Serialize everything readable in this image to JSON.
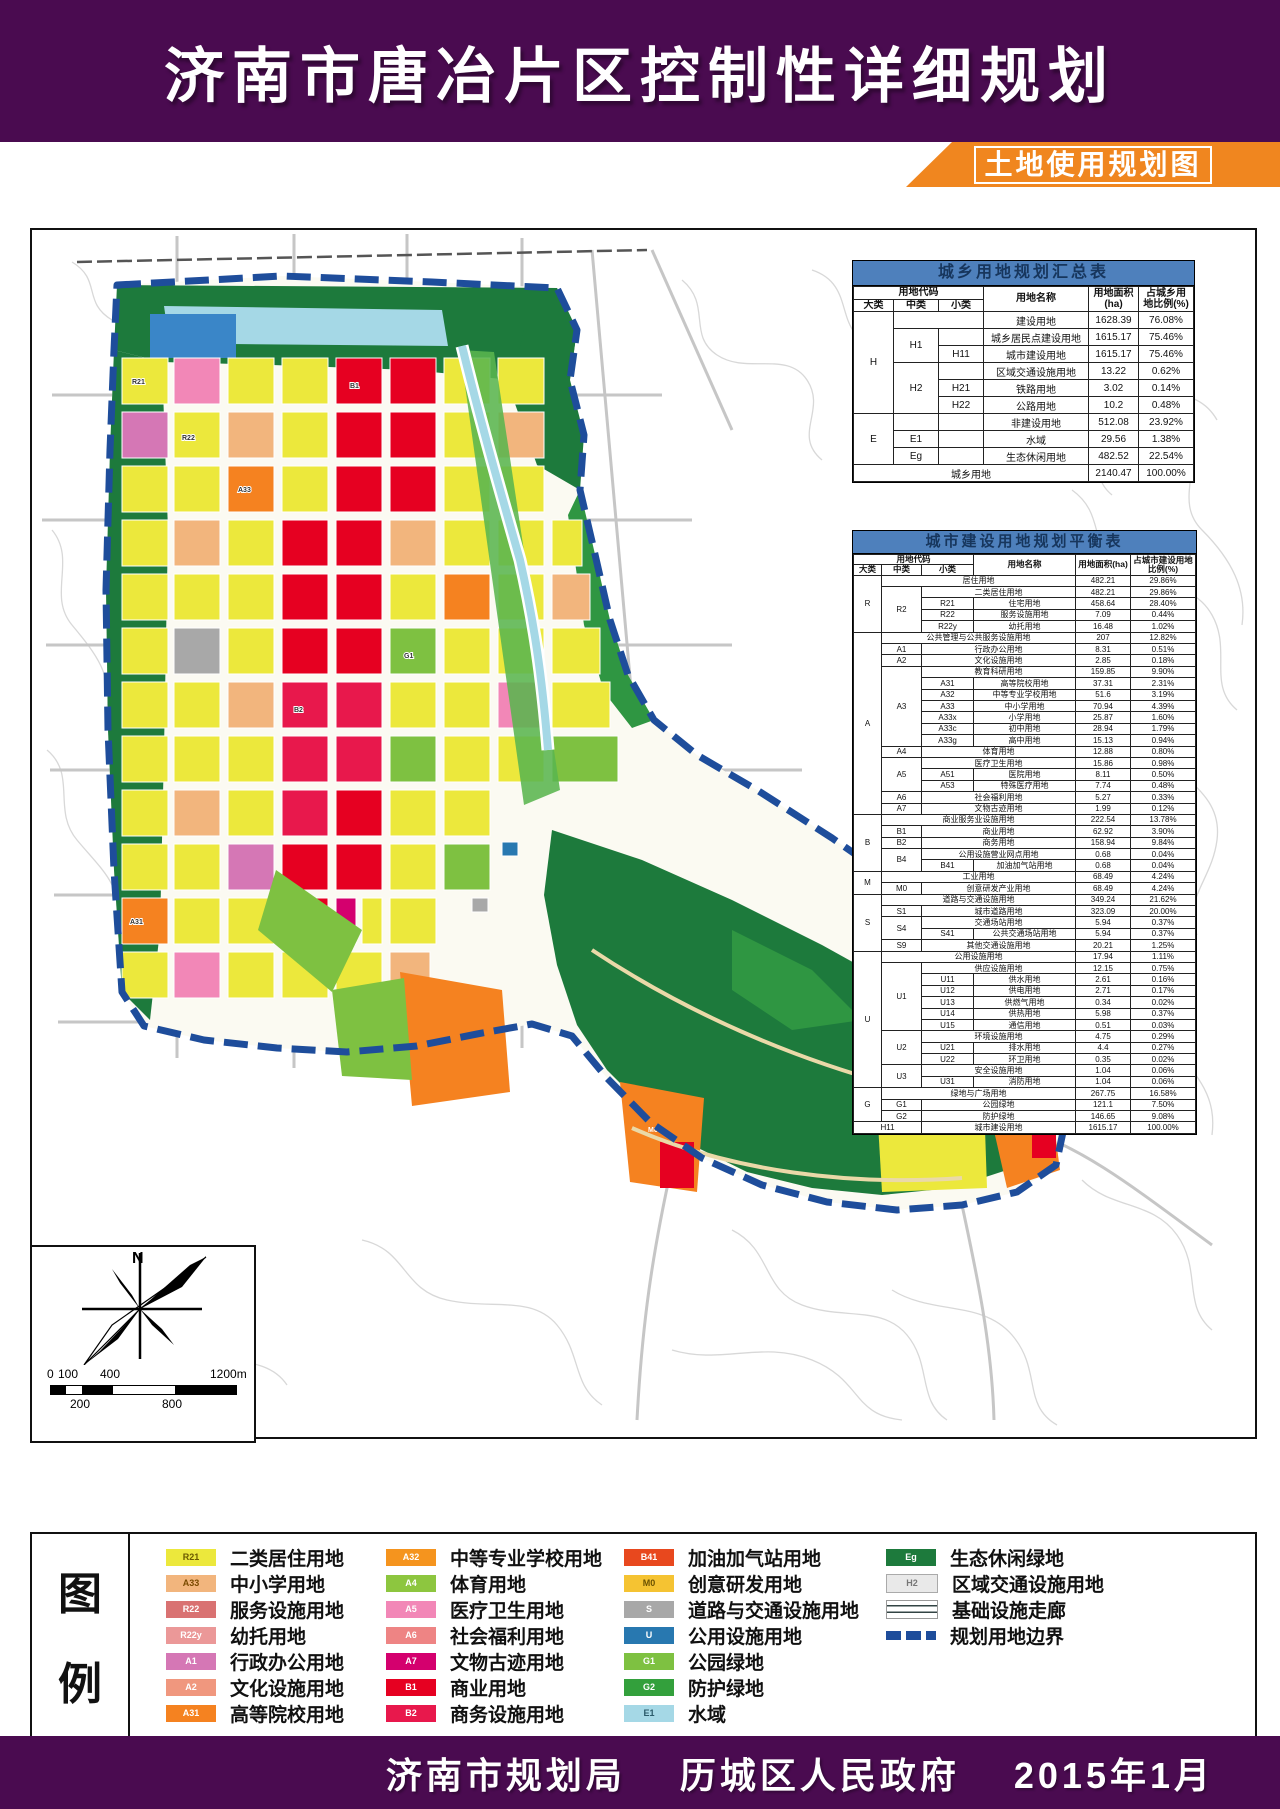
{
  "header": {
    "title": "济南市唐冶片区控制性详细规划",
    "subtitle": "土地使用规划图"
  },
  "footer": {
    "text": "济南市规划局　 历城区人民政府　 2015年1月"
  },
  "colors": {
    "banner_purple": "#4a0b50",
    "ribbon_orange": "#f0861f",
    "table_header_blue": "#4e80bc",
    "boundary_blue": "#1e4d9b"
  },
  "compass": {
    "north_label": "N"
  },
  "scalebar": {
    "top_labels": [
      "0",
      "100",
      "400",
      "1200m"
    ],
    "bottom_labels": [
      "200",
      "800"
    ]
  },
  "map": {
    "block_labels": [
      "R21",
      "A33",
      "B1",
      "B2",
      "G1",
      "A31",
      "R22",
      "M0"
    ]
  },
  "t1": {
    "title": "城乡用地规划汇总表",
    "h_code": "用地代码",
    "h_da": "大类",
    "h_zhong": "中类",
    "h_xiao": "小类",
    "h_name": "用地名称",
    "h_area": "用地面积\n(ha)",
    "h_pct": "占城乡用\n地比例(%)",
    "rows": [
      [
        "H",
        "建设用地",
        "1628.39",
        "76.08%"
      ],
      [
        "H1",
        "城乡居民点建设用地",
        "1615.17",
        "75.46%"
      ],
      [
        "H11",
        "城市建设用地",
        "1615.17",
        "75.46%"
      ],
      [
        "H2",
        "区域交通设施用地",
        "13.22",
        "0.62%"
      ],
      [
        "H21",
        "铁路用地",
        "3.02",
        "0.14%"
      ],
      [
        "H22",
        "公路用地",
        "10.2",
        "0.48%"
      ],
      [
        "E",
        "非建设用地",
        "512.08",
        "23.92%"
      ],
      [
        "E1",
        "水域",
        "29.56",
        "1.38%"
      ],
      [
        "Eg",
        "生态休闲用地",
        "482.52",
        "22.54%"
      ],
      [
        "城乡用地",
        "2140.47",
        "100.00%"
      ]
    ]
  },
  "t2": {
    "title": "城市建设用地规划平衡表",
    "h_code": "用地代码",
    "h_da": "大类",
    "h_zhong": "中类",
    "h_xiao": "小类",
    "h_name": "用地名称",
    "h_area": "用地面积(ha)",
    "h_pct": "占城市建设用地比例(%)",
    "rows": [
      [
        "R",
        "居住用地",
        "482.21",
        "29.86%"
      ],
      [
        "R2",
        "二类居住用地",
        "482.21",
        "29.86%"
      ],
      [
        "R21",
        "住宅用地",
        "458.64",
        "28.40%"
      ],
      [
        "R22",
        "服务设施用地",
        "7.09",
        "0.44%"
      ],
      [
        "R22y",
        "幼托用地",
        "16.48",
        "1.02%"
      ],
      [
        "A",
        "公共管理与公共服务设施用地",
        "207",
        "12.82%"
      ],
      [
        "A1",
        "行政办公用地",
        "8.31",
        "0.51%"
      ],
      [
        "A2",
        "文化设施用地",
        "2.85",
        "0.18%"
      ],
      [
        "A3",
        "教育科研用地",
        "159.85",
        "9.90%"
      ],
      [
        "A31",
        "高等院校用地",
        "37.31",
        "2.31%"
      ],
      [
        "A32",
        "中等专业学校用地",
        "51.6",
        "3.19%"
      ],
      [
        "A33",
        "中小学用地",
        "70.94",
        "4.39%"
      ],
      [
        "A33x",
        "小学用地",
        "25.87",
        "1.60%"
      ],
      [
        "A33c",
        "初中用地",
        "28.94",
        "1.79%"
      ],
      [
        "A33g",
        "高中用地",
        "15.13",
        "0.94%"
      ],
      [
        "A4",
        "体育用地",
        "12.88",
        "0.80%"
      ],
      [
        "A5",
        "医疗卫生用地",
        "15.86",
        "0.98%"
      ],
      [
        "A51",
        "医院用地",
        "8.11",
        "0.50%"
      ],
      [
        "A53",
        "特殊医疗用地",
        "7.74",
        "0.48%"
      ],
      [
        "A6",
        "社会福利用地",
        "5.27",
        "0.33%"
      ],
      [
        "A7",
        "文物古迹用地",
        "1.99",
        "0.12%"
      ],
      [
        "B",
        "商业服务业设施用地",
        "222.54",
        "13.78%"
      ],
      [
        "B1",
        "商业用地",
        "62.92",
        "3.90%"
      ],
      [
        "B2",
        "商务用地",
        "158.94",
        "9.84%"
      ],
      [
        "B4",
        "公用设施营业网点用地",
        "0.68",
        "0.04%"
      ],
      [
        "B41",
        "加油加气站用地",
        "0.68",
        "0.04%"
      ],
      [
        "M",
        "工业用地",
        "68.49",
        "4.24%"
      ],
      [
        "M0",
        "创意研发产业用地",
        "68.49",
        "4.24%"
      ],
      [
        "S",
        "道路与交通设施用地",
        "349.24",
        "21.62%"
      ],
      [
        "S1",
        "城市道路用地",
        "323.09",
        "20.00%"
      ],
      [
        "S4",
        "交通场站用地",
        "5.94",
        "0.37%"
      ],
      [
        "S41",
        "公共交通场站用地",
        "5.94",
        "0.37%"
      ],
      [
        "S9",
        "其他交通设施用地",
        "20.21",
        "1.25%"
      ],
      [
        "U",
        "公用设施用地",
        "17.94",
        "1.11%"
      ],
      [
        "U1",
        "供应设施用地",
        "12.15",
        "0.75%"
      ],
      [
        "U11",
        "供水用地",
        "2.61",
        "0.16%"
      ],
      [
        "U12",
        "供电用地",
        "2.71",
        "0.17%"
      ],
      [
        "U13",
        "供燃气用地",
        "0.34",
        "0.02%"
      ],
      [
        "U14",
        "供热用地",
        "5.98",
        "0.37%"
      ],
      [
        "U15",
        "通信用地",
        "0.51",
        "0.03%"
      ],
      [
        "U2",
        "环境设施用地",
        "4.75",
        "0.29%"
      ],
      [
        "U21",
        "排水用地",
        "4.4",
        "0.27%"
      ],
      [
        "U22",
        "环卫用地",
        "0.35",
        "0.02%"
      ],
      [
        "U3",
        "安全设施用地",
        "1.04",
        "0.06%"
      ],
      [
        "U31",
        "消防用地",
        "1.04",
        "0.06%"
      ],
      [
        "G",
        "绿地与广场用地",
        "267.75",
        "16.58%"
      ],
      [
        "G1",
        "公园绿地",
        "121.1",
        "7.50%"
      ],
      [
        "G2",
        "防护绿地",
        "146.65",
        "9.08%"
      ],
      [
        "H11",
        "城市建设用地",
        "1615.17",
        "100.00%"
      ]
    ]
  },
  "legend": {
    "title_lines": [
      "图",
      "例"
    ],
    "columns": [
      {
        "items": [
          {
            "code": "R21",
            "label": "二类居住用地",
            "color": "#ece83c",
            "code_color": "#6b5a00"
          },
          {
            "code": "A33",
            "label": "中小学用地",
            "color": "#f2b57d",
            "code_color": "#7a4a00"
          },
          {
            "code": "R22",
            "label": "服务设施用地",
            "color": "#d97272",
            "code_color": "#fff"
          },
          {
            "code": "R22y",
            "label": "幼托用地",
            "color": "#eb9898",
            "code_color": "#fff"
          },
          {
            "code": "A1",
            "label": "行政办公用地",
            "color": "#d577b5",
            "code_color": "#fff"
          },
          {
            "code": "A2",
            "label": "文化设施用地",
            "color": "#f0977e",
            "code_color": "#fff"
          },
          {
            "code": "A31",
            "label": "高等院校用地",
            "color": "#f58220",
            "code_color": "#fff"
          }
        ]
      },
      {
        "items": [
          {
            "code": "A32",
            "label": "中等专业学校用地",
            "color": "#f5941e",
            "code_color": "#fff"
          },
          {
            "code": "A4",
            "label": "体育用地",
            "color": "#8dc63f",
            "code_color": "#fff"
          },
          {
            "code": "A5",
            "label": "医疗卫生用地",
            "color": "#f287b7",
            "code_color": "#fff"
          },
          {
            "code": "A6",
            "label": "社会福利用地",
            "color": "#ee8484",
            "code_color": "#fff"
          },
          {
            "code": "A7",
            "label": "文物古迹用地",
            "color": "#d4006e",
            "code_color": "#fff"
          },
          {
            "code": "B1",
            "label": "商业用地",
            "color": "#e60021",
            "code_color": "#fff"
          },
          {
            "code": "B2",
            "label": "商务设施用地",
            "color": "#e8184c",
            "code_color": "#fff"
          }
        ]
      },
      {
        "items": [
          {
            "code": "B41",
            "label": "加油加气站用地",
            "color": "#e8481e",
            "code_color": "#fff"
          },
          {
            "code": "M0",
            "label": "创意研发用地",
            "color": "#f5c332",
            "code_color": "#6b5200"
          },
          {
            "code": "S",
            "label": "道路与交通设施用地",
            "color": "#a8a8a8",
            "code_color": "#fff"
          },
          {
            "code": "U",
            "label": "公用设施用地",
            "color": "#2878b0",
            "code_color": "#fff"
          },
          {
            "code": "G1",
            "label": "公园绿地",
            "color": "#7ec141",
            "code_color": "#fff"
          },
          {
            "code": "G2",
            "label": "防护绿地",
            "color": "#33a03c",
            "code_color": "#fff"
          },
          {
            "code": "E1",
            "label": "水域",
            "color": "#a5d8e6",
            "code_color": "#2a5a6a"
          }
        ]
      },
      {
        "items": [
          {
            "code": "Eg",
            "label": "生态休闲绿地",
            "color": "#1d7a3c",
            "code_color": "#fff"
          },
          {
            "code": "H2",
            "label": "区域交通设施用地",
            "color": "#e9e9e9",
            "code_color": "#777"
          },
          {
            "code": "",
            "label": "基础设施走廊",
            "color": "",
            "code_color": ""
          },
          {
            "code": "",
            "label": "规划用地边界",
            "color": "",
            "code_color": ""
          }
        ]
      }
    ]
  }
}
